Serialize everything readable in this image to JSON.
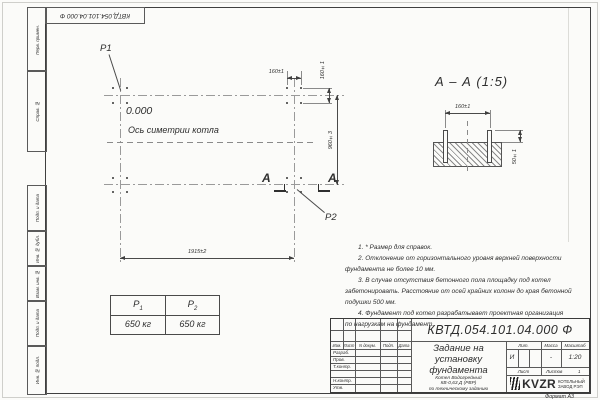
{
  "sheet": {
    "stamp_doc_number": "КВТД.054.101.04.000 Ф",
    "side_labels": [
      "Перв. примен.",
      "Справ. №",
      "Подп. и дата",
      "Инв. № дубл.",
      "Взам. инв. №",
      "Подп. и дата",
      "Инв. № подл."
    ],
    "format_note": "Формат А3"
  },
  "plan": {
    "p1_label": "P1",
    "p2_label": "P2",
    "elevation": "0.000",
    "symmetry_axis_label": "Ось симетрии котла",
    "section_letter_left": "А",
    "section_letter_right": "А",
    "dim_bolt_spacing_x": "160±1",
    "dim_bolt_spacing_y": "160±1",
    "dim_row_distance": "960±3",
    "dim_col_distance": "1915±2"
  },
  "section": {
    "title": "А – А (1:5)",
    "dim_bolt_spacing": "160±1",
    "dim_bolt_height": "50±1"
  },
  "notes": {
    "lines": [
      "1. * Размер для справок.",
      "2. Отклонение от горизонтального уровня верхней поверхности",
      "фундамента не более 10 мм.",
      "3. В случае отсутствия бетонного пола площадку под котел",
      "забетонировать. Расстояние от осей крайних колонн до края бетонной",
      "подушки 500 мм.",
      "4. Фундамент под котел разрабатывает проектная организация",
      "по нагрузкам на фундамент."
    ]
  },
  "load_table": {
    "col1_label": "P",
    "col1_sub": "1",
    "col2_label": "P",
    "col2_sub": "2",
    "col1_value": "650 кг",
    "col2_value": "650 кг"
  },
  "title_block": {
    "doc_number": "КВТД.054.101.04.000  Ф",
    "doc_title_lines": [
      "Задание на",
      "установку",
      "фундамента"
    ],
    "product_lines": [
      "Котел Водогрейный",
      "КВ-0,63 Д (РВР)",
      "по техническому заданию"
    ],
    "change_cols": [
      "Изм.",
      "Лист",
      "N докум.",
      "Подп.",
      "Дата"
    ],
    "roles": [
      "Разраб.",
      "Пров.",
      "Т.контр.",
      "",
      "Н.контр.",
      "Утв."
    ],
    "lit_label": "Лит.",
    "mass_label": "Масса",
    "scale_label": "Масштаб",
    "lit_value": "И",
    "mass_value": "-",
    "scale_value": "1:20",
    "sheet_label": "Лист",
    "sheets_label": "Листов",
    "sheets_value": "1",
    "logo_text": "KVZR",
    "logo_caption_line1": "КОТЕЛЬНЫЙ",
    "logo_caption_line2": "ЗАВОД РЭП"
  }
}
